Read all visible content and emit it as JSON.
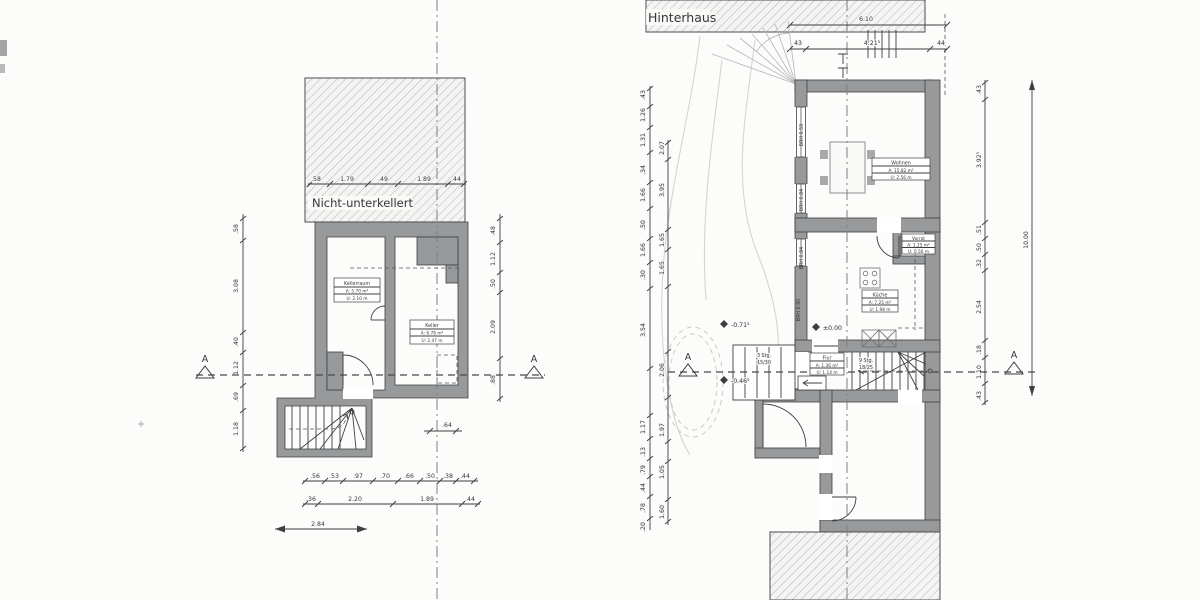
{
  "colors": {
    "paper": "#fcfcfb",
    "wall_gray": "#98999b",
    "line_dark": "#3c3f42",
    "hatch": "#b8bbbc",
    "terrain_faint": "#d2d5d2"
  },
  "left_plan": {
    "title": "Nicht-unterkellert",
    "top_dims": [
      ".58",
      "1.79",
      ".49",
      "1.89",
      ".44"
    ],
    "left_chain": [
      ".58",
      "3.08",
      ".40",
      "1.12",
      ".69",
      "1.18"
    ],
    "right_chain": [
      ".48",
      "1.12",
      ".50",
      "2.09",
      ".88"
    ],
    "bottom_row1": [
      ".56",
      ".53",
      ".97",
      ".70",
      ".66",
      ".50",
      ".38",
      ".44"
    ],
    "bottom_row2": [
      ".36",
      "2.20",
      "1.89",
      ".44"
    ],
    "bottom_total": "2.84",
    "offset_dim": ".64",
    "rooms": {
      "kellerraum": {
        "name": "Kellerraum",
        "area": "A: 5.70 m²",
        "u": "U: 2.10 m"
      },
      "keller": {
        "name": "Keller",
        "area": "A: 6.78 m²",
        "u": "U: 2.47 m"
      }
    },
    "section_letter": "A"
  },
  "right_plan": {
    "title": "Hinterhaus",
    "top_total": "6.10",
    "top_dims": [
      "43",
      "4.21⁵",
      "44"
    ],
    "left_outer_chain": [
      ".43",
      "1.26",
      "1.31",
      ".34",
      "1.66",
      ".50",
      "1.66",
      ".30",
      "3.54",
      "1.17",
      ".13",
      ".79",
      ".44",
      ".78",
      ".20"
    ],
    "left_inner_chain": [
      "2.07",
      "3.95",
      "1.65",
      "1.65",
      "2.06",
      "1.97",
      "1.05",
      "1.60"
    ],
    "right_chain": [
      ".43",
      "3.92⁵",
      ".51",
      ".50",
      ".32",
      "2.54",
      ".18",
      "1.10",
      ".43"
    ],
    "right_total": "10.00",
    "brh_labels": [
      "BRH 0.59",
      "BRH 0.84",
      "BRH 0.84",
      "BRH 0.90"
    ],
    "elevations": {
      "terrace": "-0.71⁵",
      "floor": "±0.00",
      "path": "-0.46⁵"
    },
    "rooms": {
      "wohnen": {
        "name": "Wohnen",
        "area": "A: 15.82 m²",
        "u": "U: 2.56 m"
      },
      "vorrat": {
        "name": "Vorrat",
        "area": "A: 1.25 m²",
        "u": "U: 0.56 m"
      },
      "kueche": {
        "name": "Küche",
        "area": "A: 7.25 m²",
        "u": "U: 1.98 m"
      },
      "flur": {
        "name": "Flur",
        "area": "A: 1.36 m²",
        "u": "U: 1.14 m"
      }
    },
    "stairs": {
      "outside": {
        "count": "3 Stg.",
        "ratio": "15/30"
      },
      "inside": {
        "count": "9 Stg.",
        "ratio": "18/25"
      }
    },
    "section_letter": "A"
  }
}
